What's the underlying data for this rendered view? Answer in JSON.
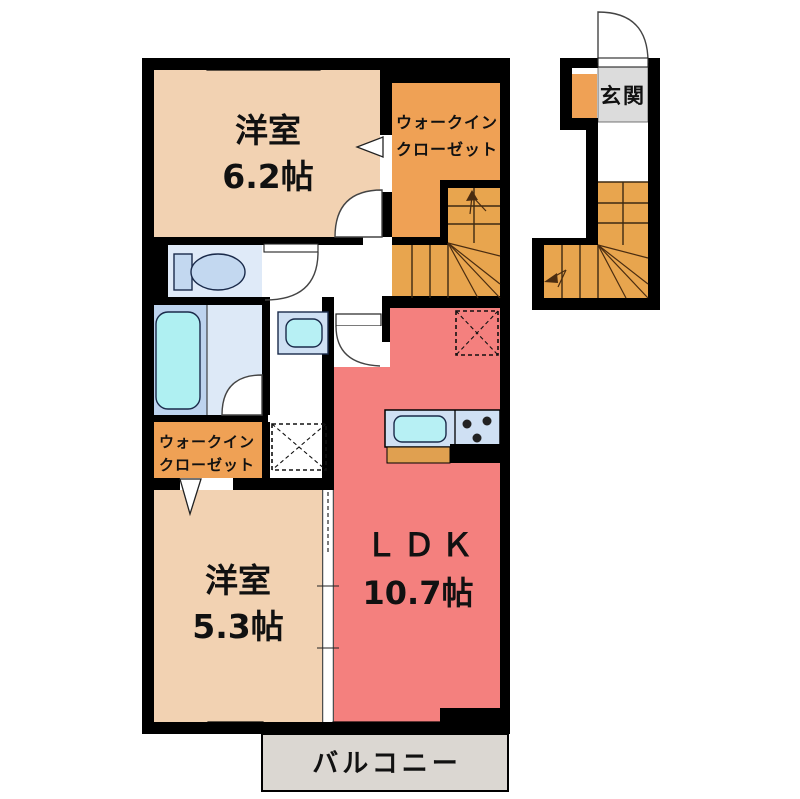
{
  "plan_title": "2F apartment floor plan",
  "rooms": {
    "bedroom_main": {
      "label": "洋室",
      "size": "6.2帖"
    },
    "wic_top": {
      "line1": "ウォークイン",
      "line2": "クローゼット"
    },
    "entrance": {
      "label": "玄関"
    },
    "wic_left": {
      "line1": "ウォークイン",
      "line2": "クローゼット"
    },
    "bedroom_second": {
      "label": "洋室",
      "size": "5.3帖"
    },
    "ldk": {
      "label": "ＬＤＫ",
      "size": "10.7帖"
    },
    "balcony": {
      "label": "バルコニー"
    }
  },
  "colors": {
    "wall": "#000000",
    "room_peach": "#f2d2b2",
    "closet_orange": "#efa155",
    "stairs_orange": "#e8a54e",
    "ldk_pink": "#f4807e",
    "bath_blue": "#bdd3ee",
    "bath_light": "#dde9f7",
    "toilet_blue": "#dfeaf8",
    "fixture_blue": "#c3d8f0",
    "tub_cyan": "#aff0f2",
    "counter_blue": "#cfe0f3",
    "sink_cyan": "#b7f0f4",
    "counter_wood": "#e0a050",
    "balcony_gray": "#dbd7d2",
    "entrance_gray": "#dcdcdc",
    "white": "#ffffff"
  }
}
